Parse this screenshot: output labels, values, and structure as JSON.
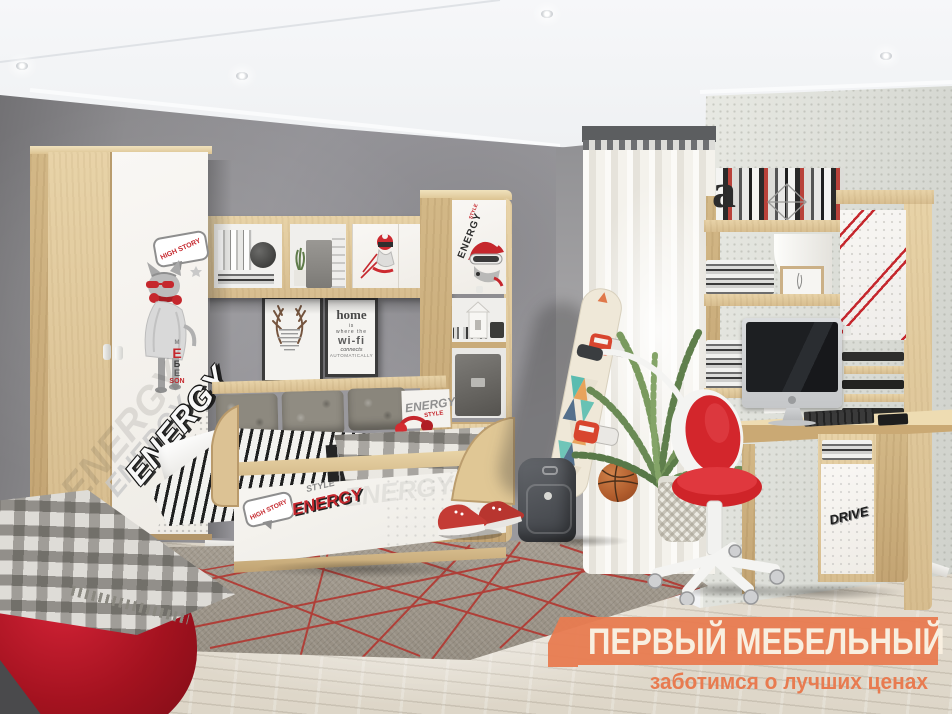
{
  "watermark": {
    "title": "ПЕРВЫЙ МЕБЕЛЬНЫЙ",
    "subtitle": "заботимся о лучших ценах",
    "banner_color": "#e87b50",
    "title_color": "#f8efe0"
  },
  "prints": {
    "energy": "ENERGY",
    "style": "STYLE",
    "bubble": "HIGH STORY",
    "drive": "DRIVE",
    "shelf_letter": "a",
    "cat_tag": [
      "M",
      "E",
      "Б",
      "Е",
      "SON"
    ]
  },
  "wifi_poster": {
    "l1": "home",
    "l2": "is",
    "l3": "where the",
    "l4": "wi-fi",
    "l5": "connects",
    "l6": "AUTOMATICALLY"
  },
  "palette": {
    "oak": "#ddc69c",
    "white_front": "#f6f3ee",
    "wall_gray": "#8d8c8d",
    "accent_red": "#c5272d",
    "floor_wood": "#ded7ca",
    "carpet_gray": "#9d968b",
    "banner_orange": "#e87b50"
  }
}
